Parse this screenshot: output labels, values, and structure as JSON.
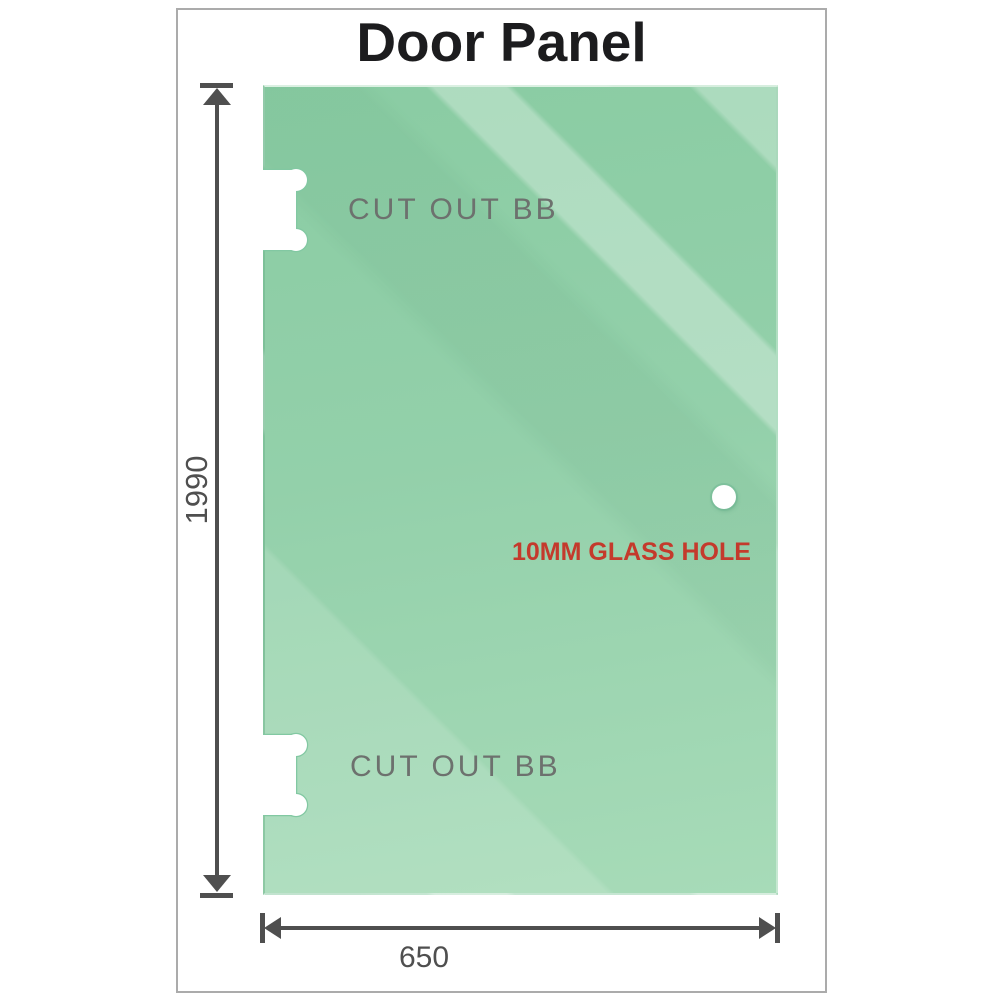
{
  "title": "Door Panel",
  "panel": {
    "cutout_top_label": "CUT OUT BB",
    "cutout_bottom_label": "CUT OUT BB",
    "hole_label": "10MM GLASS HOLE"
  },
  "dimensions": {
    "height_label": "1990",
    "width_label": "650"
  },
  "colors": {
    "glass_green_top": "#8acca3",
    "glass_green_bottom": "#a7dbb8",
    "dimension_gray": "#4f4f4f",
    "cutout_text_gray": "#6d716e",
    "hole_label_red": "#c43a2c",
    "frame_border_gray": "#ababab",
    "title_color": "#1c1c1e"
  }
}
